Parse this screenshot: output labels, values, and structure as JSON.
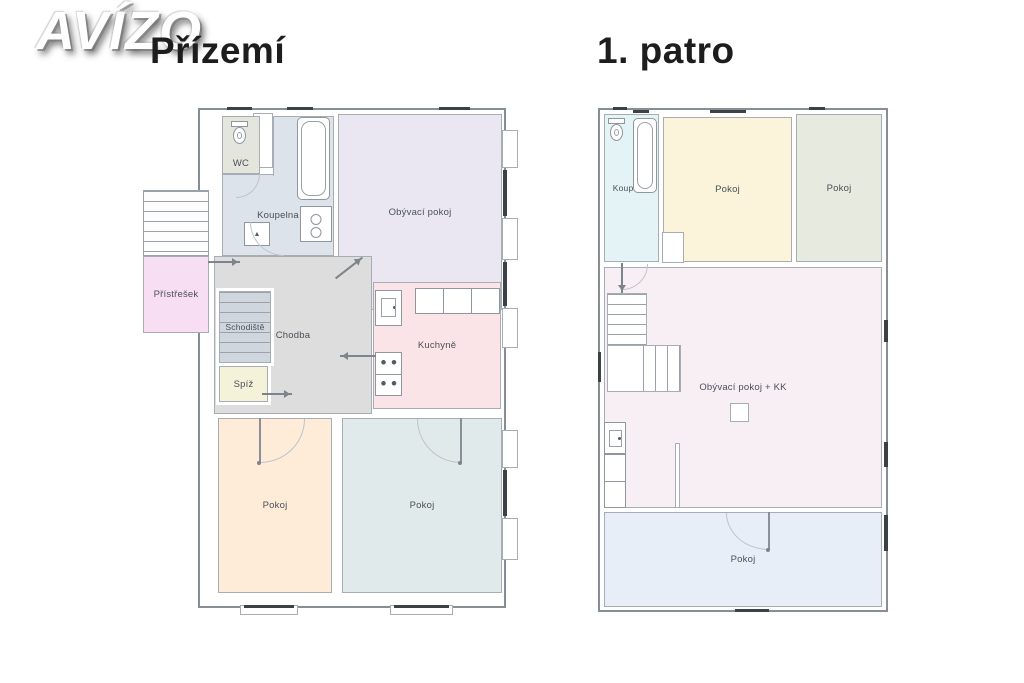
{
  "watermark": {
    "brand": "AVÍZO"
  },
  "floors": [
    {
      "title": "Přízemí",
      "rooms": {
        "wc": "WC",
        "koupelna": "Koupelna",
        "obyvaci": "Obývací pokoj",
        "pristresek": "Přístřešek",
        "schodiste": "Schodiště",
        "chodba": "Chodba",
        "spiz": "Spíž",
        "kuchyne": "Kuchyně",
        "pokoj1": "Pokoj",
        "pokoj2": "Pokoj"
      }
    },
    {
      "title": "1. patro",
      "rooms": {
        "koupelna": "Koupelna",
        "pokoj1": "Pokoj",
        "pokoj2": "Pokoj",
        "obyvaci_kk": "Obývací pokoj + KK",
        "pokoj3": "Pokoj"
      }
    }
  ],
  "colors": {
    "wall": "#878e95",
    "window_glass": "#3c4146",
    "label_text": "#4b5157",
    "title_text": "#1d1d1d",
    "ground": {
      "wc": "#e4e6dd",
      "koupelna": "#dce3ea",
      "obyvaci": "#eae7f3",
      "pristresek": "#f7def2",
      "schodiste": "#cfd6dd",
      "chodba": "#dddddd",
      "spiz": "#f4f2d9",
      "kuchyne": "#fbe4e8",
      "pokoj1": "#feecd9",
      "pokoj2": "#e1eaea"
    },
    "first": {
      "koupelna": "#e4f3f6",
      "pokoj1": "#fbf4da",
      "pokoj2": "#e6eadf",
      "obyvaci_kk": "#f7eff4",
      "pokoj3": "#e7eef8"
    }
  }
}
